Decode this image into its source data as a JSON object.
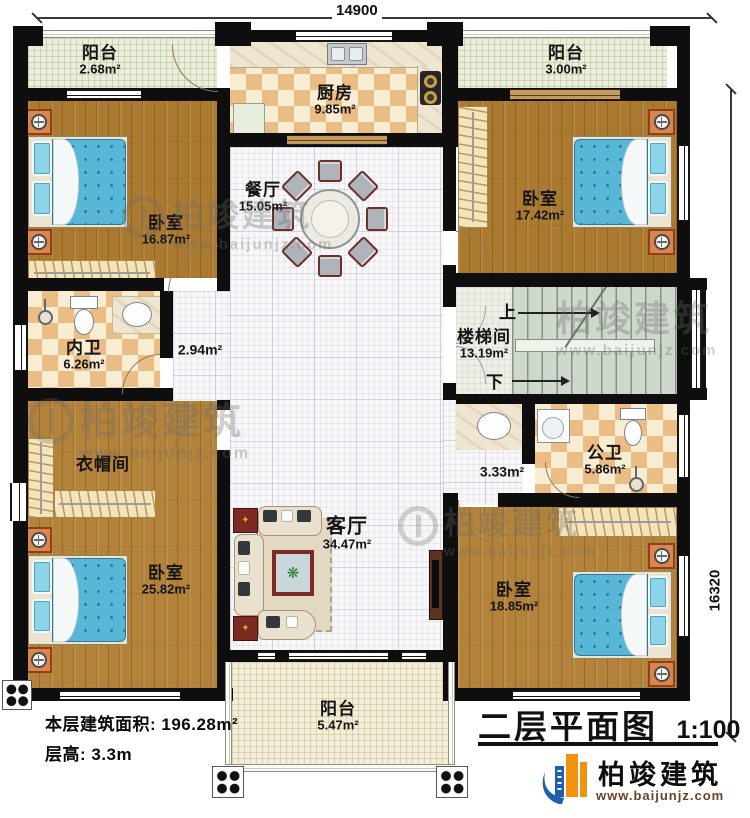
{
  "header": {
    "dim_top": "14900",
    "dim_right": "16320"
  },
  "rooms": {
    "balcony_tl": {
      "name": "阳台",
      "area": "2.68m²"
    },
    "kitchen": {
      "name": "厨房",
      "area": "9.85m²"
    },
    "balcony_tr": {
      "name": "阳台",
      "area": "3.00m²"
    },
    "bedroom_tl": {
      "name": "卧室",
      "area": "16.87m²"
    },
    "dining": {
      "name": "餐厅",
      "area": "15.05m²"
    },
    "bedroom_tr": {
      "name": "卧室",
      "area": "17.42m²"
    },
    "bath_master": {
      "name": "内卫",
      "area": "6.26m²"
    },
    "hall_left": {
      "area": "2.94m²"
    },
    "stairwell": {
      "name": "楼梯间",
      "area": "13.19m²",
      "up": "上",
      "down": "下"
    },
    "cloakroom": {
      "name": "衣帽间"
    },
    "bath_public": {
      "name": "公卫",
      "area": "5.86m²"
    },
    "hall_right": {
      "area": "3.33m²"
    },
    "bedroom_bl": {
      "name": "卧室",
      "area": "25.82m²"
    },
    "living": {
      "name": "客厅",
      "area": "34.47m²"
    },
    "bedroom_br": {
      "name": "卧室",
      "area": "18.85m²"
    },
    "balcony_b": {
      "name": "阳台",
      "area": "5.47m²"
    }
  },
  "footer": {
    "area_label": "本层建筑面积: 196.28m²",
    "height_label": "层高: 3.3m",
    "title": "二层平面图",
    "scale": "1:100"
  },
  "brand": {
    "name": "柏竣建筑",
    "url": "www.baijunjz.com"
  }
}
